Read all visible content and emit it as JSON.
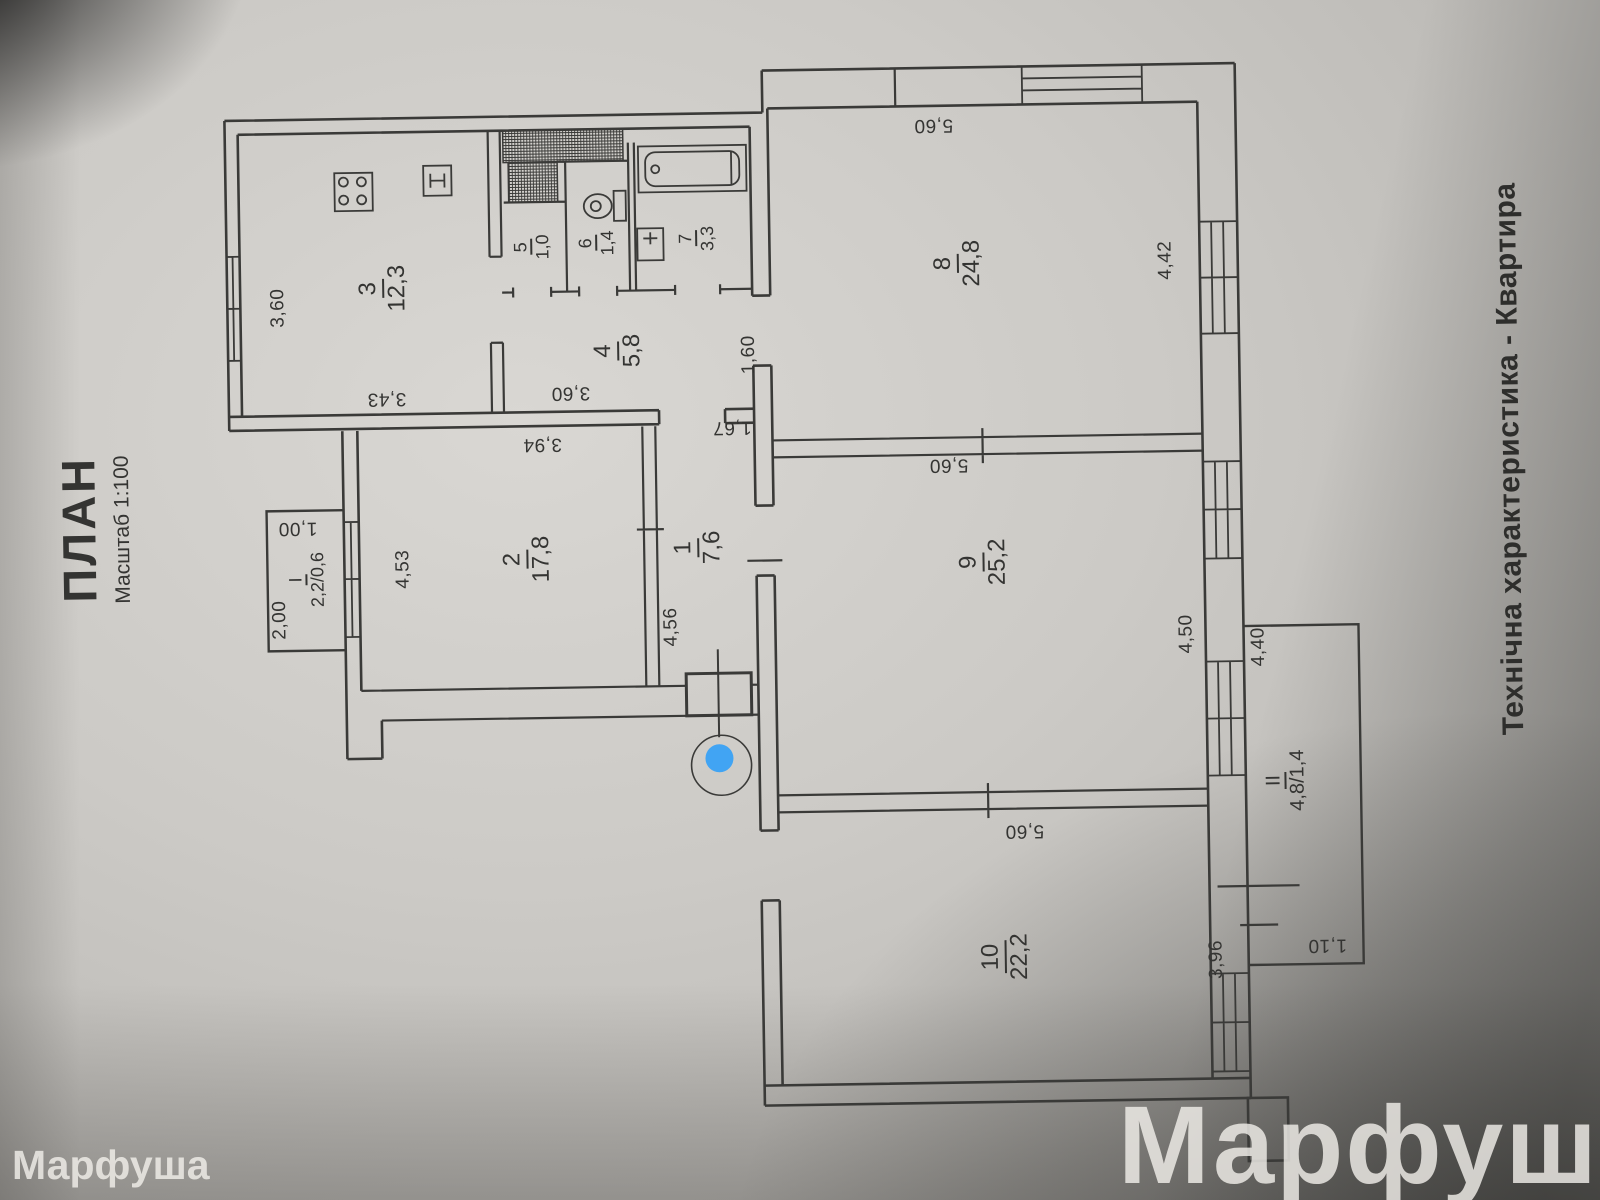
{
  "page": {
    "title": "ПЛАН",
    "scale": "Масштаб 1:100",
    "side_title": "Технічна характеристика - Квартира",
    "watermark": "Марфуша"
  },
  "rooms": [
    {
      "id": "1",
      "number": "1",
      "area": "7,6"
    },
    {
      "id": "2",
      "number": "2",
      "area": "17,8"
    },
    {
      "id": "3",
      "number": "3",
      "area": "12,3"
    },
    {
      "id": "4",
      "number": "4",
      "area": "5,8"
    },
    {
      "id": "5",
      "number": "5",
      "area": "1,0"
    },
    {
      "id": "6",
      "number": "6",
      "area": "1,4"
    },
    {
      "id": "7",
      "number": "7",
      "area": "3,3"
    },
    {
      "id": "8",
      "number": "8",
      "area": "24,8"
    },
    {
      "id": "9",
      "number": "9",
      "area": "25,2"
    },
    {
      "id": "10",
      "number": "10",
      "area": "22,2"
    },
    {
      "id": "I",
      "number": "I",
      "area": "2,2/0,6"
    },
    {
      "id": "II",
      "number": "II",
      "area": "4,8/1,4"
    }
  ],
  "dimensions": {
    "kitchen_left": "3,60",
    "kitchen_bottom": "3,43",
    "hall_bottom": "3,60",
    "corridor_width": "1,60",
    "corridor_top": "1,67",
    "room2_top": "3,94",
    "room2_left": "4,53",
    "room1_bottom": "4,56",
    "balcony1_length": "2,00",
    "balcony1_width": "1,00",
    "room8_top": "5,60",
    "room8_right": "4,42",
    "room9_top": "5,60",
    "room9_right": "4,50",
    "room10_top": "5,60",
    "room10_right": "3,96",
    "balcony2_top": "4,40",
    "balcony2_bottom": "1,10"
  },
  "colors": {
    "ink": "#343432",
    "paper": "#cfcdc9",
    "marker_blue": "#41a4f3",
    "watermark": "#f0eee9"
  }
}
